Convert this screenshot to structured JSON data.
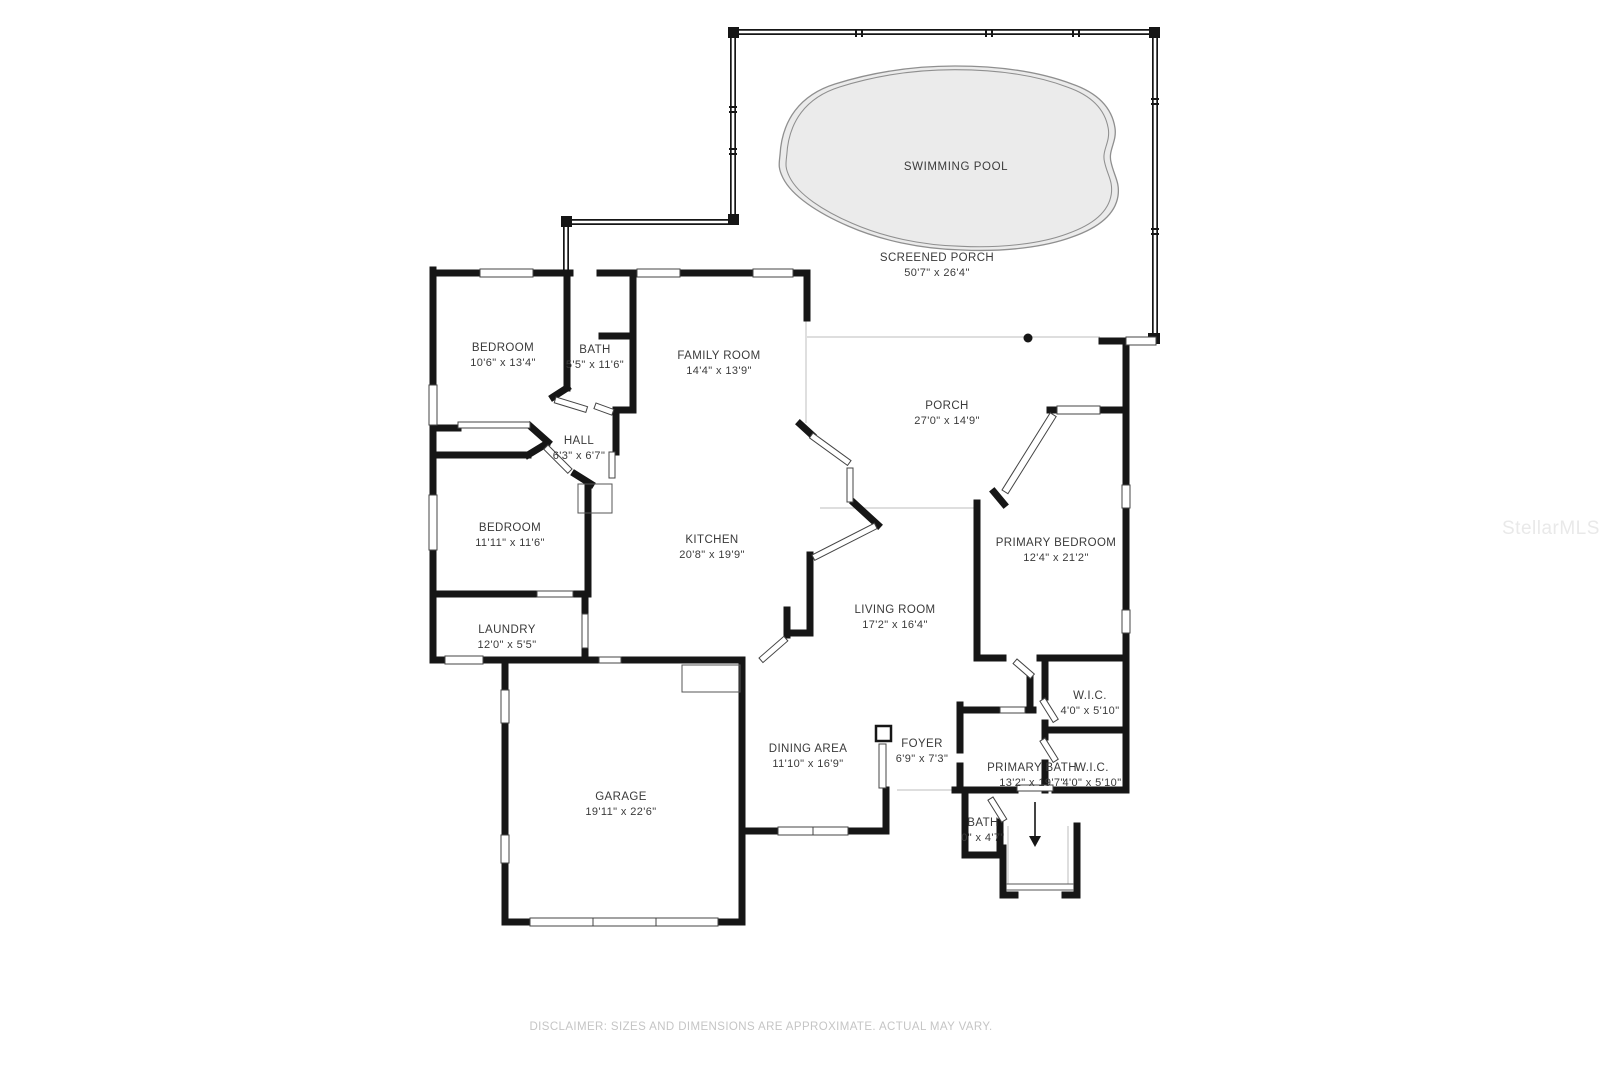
{
  "plan": {
    "pool": {
      "label": "SWIMMING POOL"
    },
    "rooms": [
      {
        "name": "SCREENED PORCH",
        "dims": "50'7\" x 26'4\""
      },
      {
        "name": "BEDROOM",
        "dims": "10'6\" x 13'4\""
      },
      {
        "name": "BATH",
        "dims": "5'5\" x 11'6\""
      },
      {
        "name": "FAMILY ROOM",
        "dims": "14'4\" x 13'9\""
      },
      {
        "name": "HALL",
        "dims": "6'3\" x 6'7\""
      },
      {
        "name": "BEDROOM",
        "dims": "11'11\" x 11'6\""
      },
      {
        "name": "KITCHEN",
        "dims": "20'8\" x 19'9\""
      },
      {
        "name": "PORCH",
        "dims": "27'0\" x 14'9\""
      },
      {
        "name": "PRIMARY BEDROOM",
        "dims": "12'4\" x 21'2\""
      },
      {
        "name": "LAUNDRY",
        "dims": "12'0\" x 5'5\""
      },
      {
        "name": "LIVING ROOM",
        "dims": "17'2\" x 16'4\""
      },
      {
        "name": "GARAGE",
        "dims": "19'11\" x 22'6\""
      },
      {
        "name": "DINING AREA",
        "dims": "11'10\" x 16'9\""
      },
      {
        "name": "FOYER",
        "dims": "6'9\" x 7'3\""
      },
      {
        "name": "PRIMARY BATH",
        "dims": "13'2\" x 19'7\""
      },
      {
        "name": "W.I.C.",
        "dims": "4'0\" x 5'10\""
      },
      {
        "name": "W.I.C.",
        "dims": "4'0\" x 5'10\""
      },
      {
        "name": "BATH",
        "dims": "0\" x 4'7\""
      }
    ]
  },
  "footer": {
    "disclaimer": "DISCLAIMER: SIZES AND DIMENSIONS ARE APPROXIMATE. ACTUAL MAY VARY."
  },
  "watermark": {
    "text": "StellarMLS"
  },
  "colors": {
    "wall": "#161616",
    "pool_fill": "#ebebeb",
    "pool_stroke": "#8f8f8f",
    "label_text": "#3a3a3a",
    "open_line": "#c9c9c9",
    "disclaimer_text": "#c5c5c5",
    "watermark_text": "#e9e9e9"
  }
}
